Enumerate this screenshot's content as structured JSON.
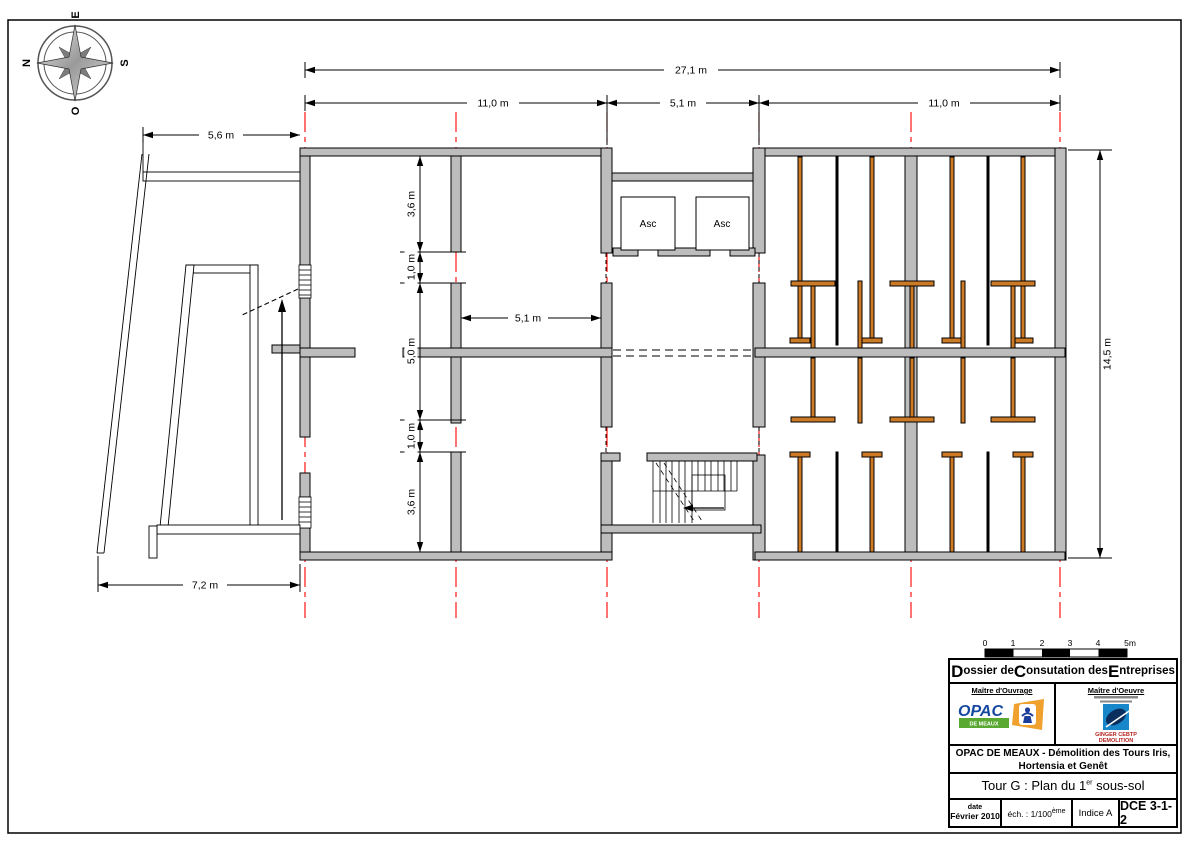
{
  "compass": {
    "top": "E",
    "left": "N",
    "right": "S",
    "bottom": "O"
  },
  "dimensions": {
    "overall_width": "27,1 m",
    "bay_left": "11,0 m",
    "bay_middle": "5,1 m",
    "bay_right": "11,0 m",
    "ramp_top": "5,6 m",
    "ramp_bottom": "7,2 m",
    "overall_height": "14,5 m",
    "chain_top": "3,6 m",
    "chain_door_top": "1,0 m",
    "chain_middle": "5,0 m",
    "chain_door_bottom": "1,0 m",
    "chain_bottom": "3,6 m",
    "room_width": "5,1 m"
  },
  "plan_labels": {
    "elevator_left": "Asc",
    "elevator_right": "Asc"
  },
  "scale_bar": {
    "ticks": [
      "0",
      "1",
      "2",
      "3",
      "4",
      "5m"
    ]
  },
  "title_block": {
    "header": {
      "big1": "D",
      "part1": "ossier de ",
      "big2": "C",
      "part2": "onsutation des ",
      "big3": "E",
      "part3": "ntreprises"
    },
    "owner": {
      "label": "Maître d'Ouvrage",
      "logo_text": "OPAC",
      "logo_sub": "DE MEAUX"
    },
    "architect": {
      "label": "Maître d'Oeuvre",
      "logo_line1": "GINGER CEBTP",
      "logo_line2": "DEMOLITION"
    },
    "project_line1": "OPAC DE MEAUX - Démolition des Tours Iris,",
    "project_line2": "Hortensia et Genêt",
    "drawing_title": {
      "pre": "Tour G : Plan du 1",
      "sup": "er",
      "post": " sous-sol"
    },
    "footer": {
      "date_label": "date",
      "date_value": "Février 2010",
      "scale_pre": "éch. : 1/100",
      "scale_sup": "ème",
      "index": "Indice A",
      "ref": "DCE 3-1-2"
    }
  }
}
